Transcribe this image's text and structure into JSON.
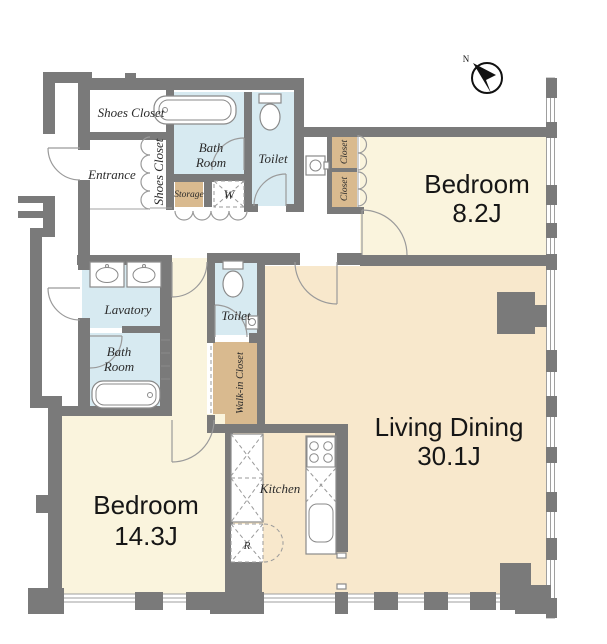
{
  "floorplan": {
    "compass": {
      "north_label": "N"
    },
    "rooms": {
      "bedroom8": {
        "name": "Bedroom",
        "size": "8.2J"
      },
      "bedroom14": {
        "name": "Bedroom",
        "size": "14.3J"
      },
      "living": {
        "name": "Living Dining",
        "size": "30.1J"
      },
      "shoes_closet_room": "Shoes Closet",
      "entrance": "Entrance",
      "shoes_closet_strip": "Shoes Closet",
      "bathroom1_line1": "Bath",
      "bathroom1_line2": "Room",
      "toilet1": "Toilet",
      "storage": "Storage",
      "washer": "W",
      "closet_upper": "Closet",
      "closet_lower": "Closet",
      "lavatory": "Lavatory",
      "bathroom2_line1": "Bath",
      "bathroom2_line2": "Room",
      "toilet2": "Toilet",
      "walk_in_closet": "Walk-in Closet",
      "kitchen": "Kitchen",
      "refrigerator": "R"
    },
    "colors": {
      "wall": "#7a7a7a",
      "cream": "#faf4dd",
      "peach": "#f8e8cc",
      "blue": "#d7eaf1",
      "tan": "#d9ba8f"
    }
  }
}
